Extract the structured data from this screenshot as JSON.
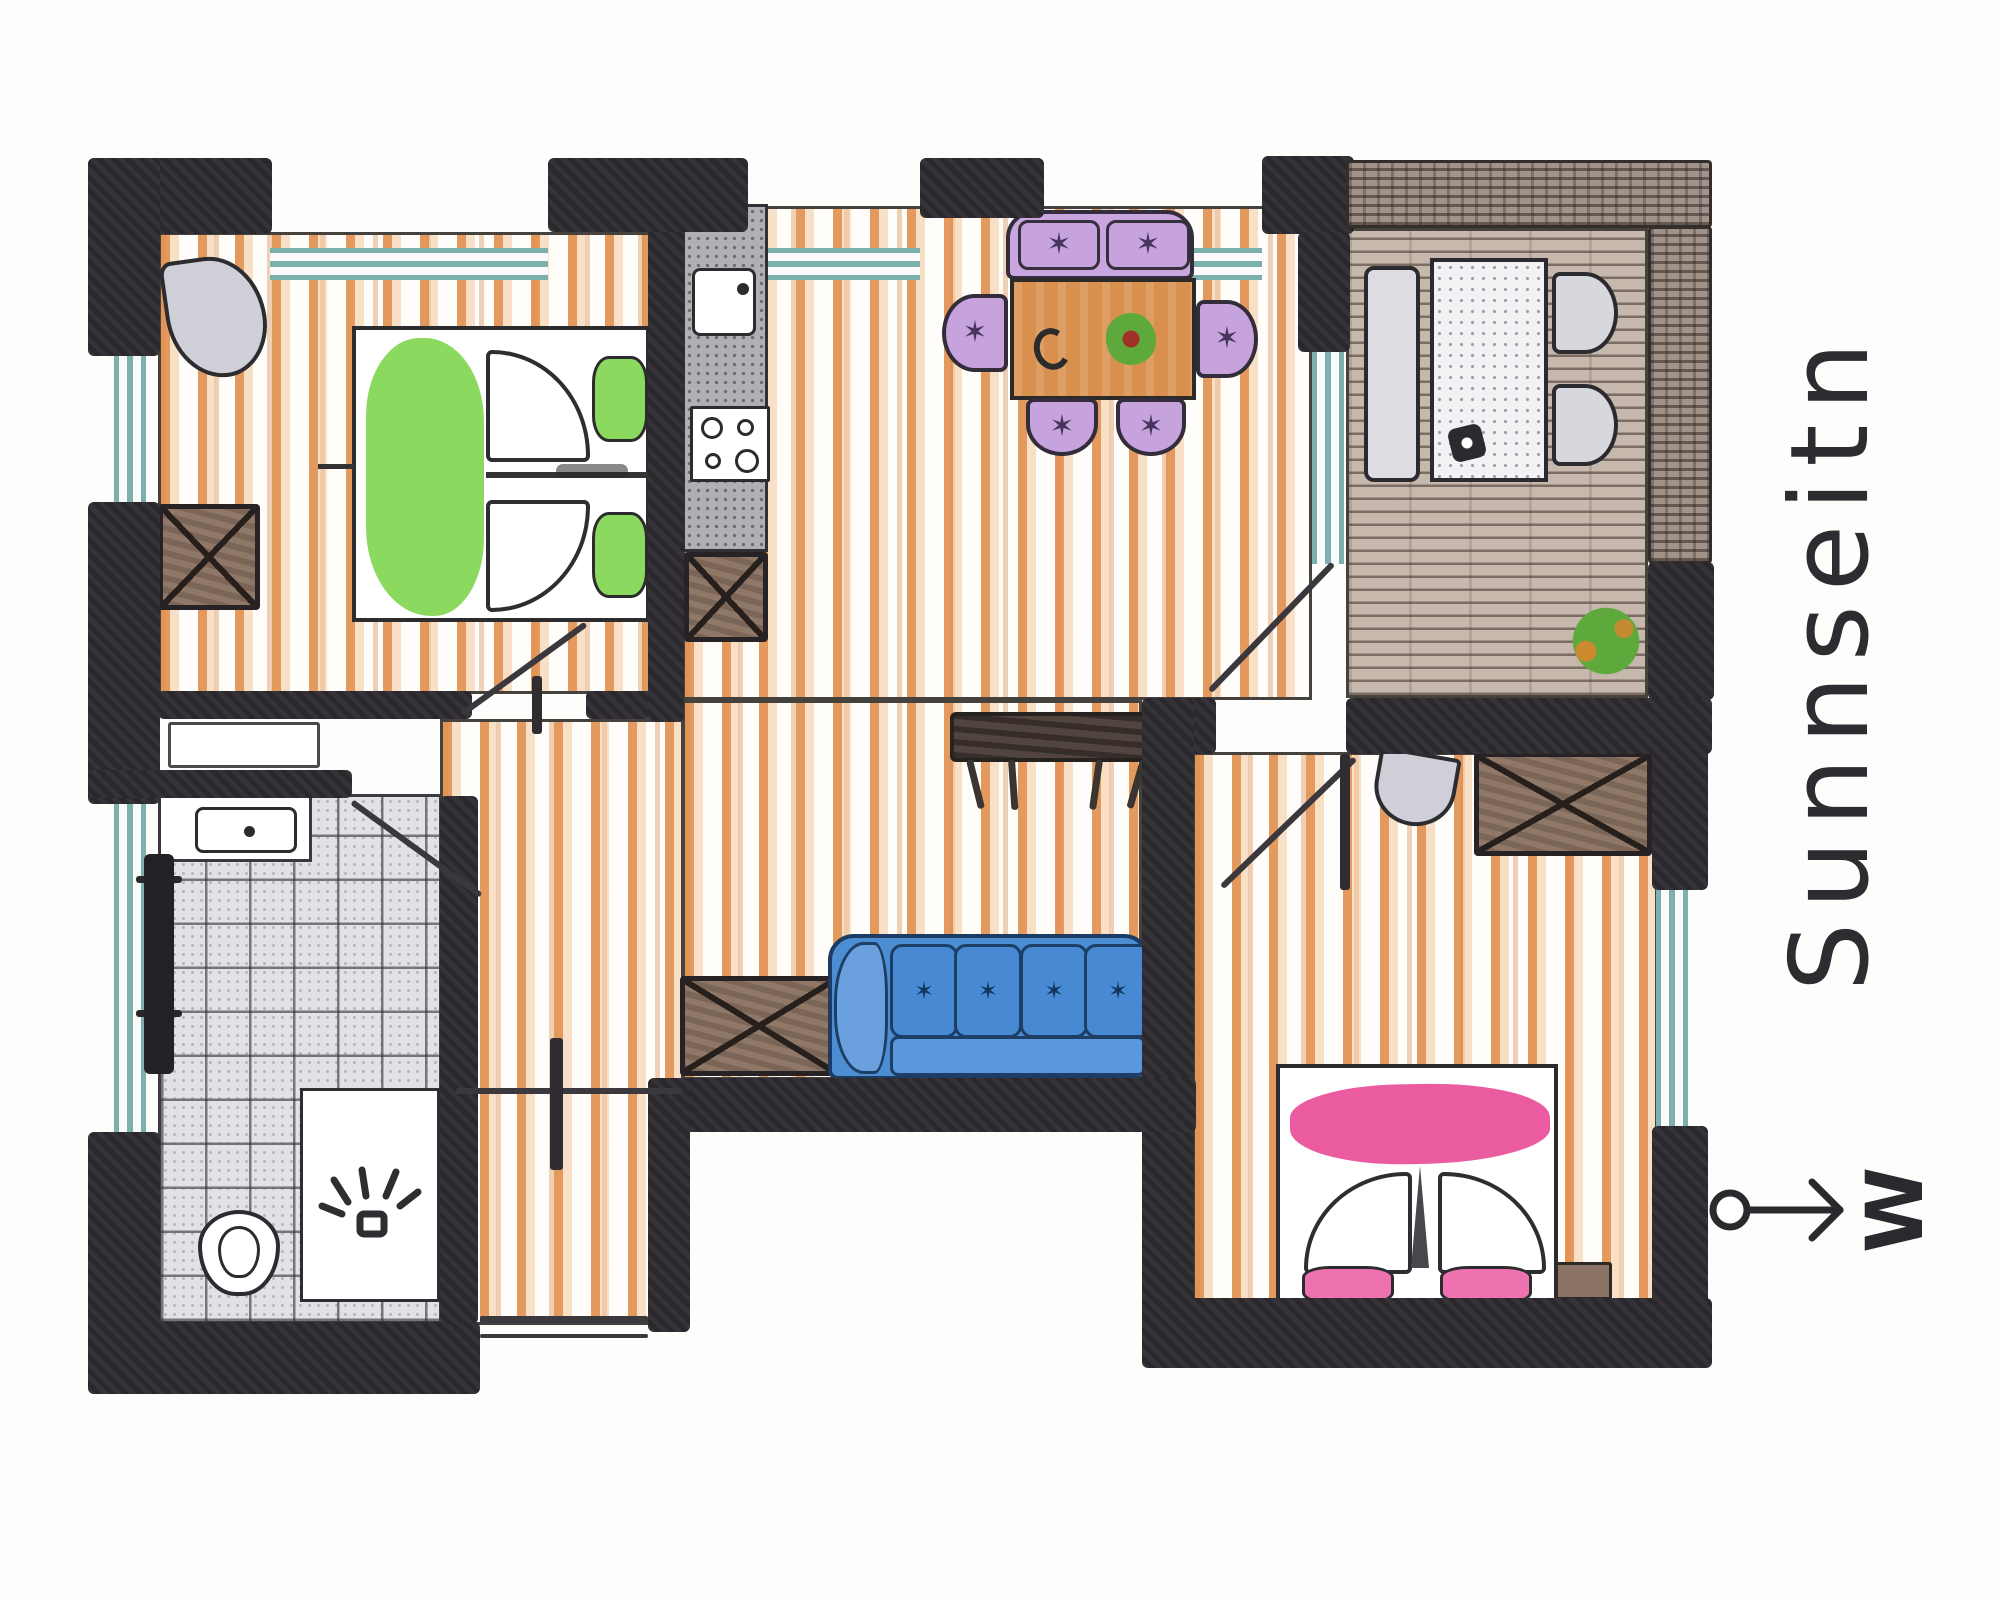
{
  "title": {
    "text": "Sunnseitn"
  },
  "compass": {
    "letter": "W"
  },
  "icons": {
    "tuft_glyph": "✶"
  },
  "colors": {
    "wall": "#2a282c",
    "window_teal": "#7bb0ad",
    "wood_orange": "#e08c48",
    "deck_base": "#c6b8ad",
    "tile_base": "#e2e2e6",
    "bed_green": "#8cd95f",
    "bed_pink": "#ea5c9f",
    "cushion_pink": "#ee72b0",
    "sofa_blue": "#4d8ed2",
    "sofa_dark": "#1d3f66",
    "chair_purple": "#c7a3dd",
    "cabinet_brown": "#907868",
    "table_wood": "#d98f4e",
    "plant_green": "#5da93c",
    "basin_gray": "#cfcfd8",
    "ink": "#2d2d31"
  }
}
